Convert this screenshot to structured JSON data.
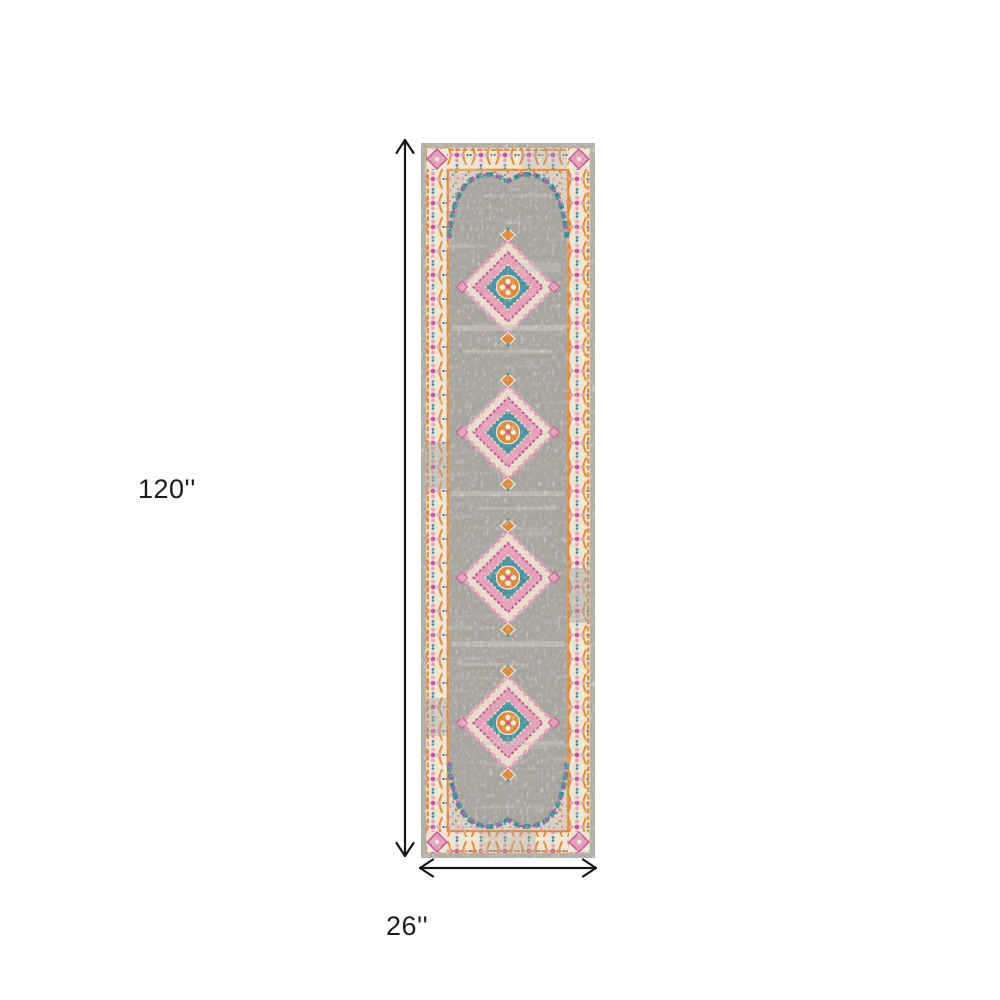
{
  "figure": {
    "background_color": "#ffffff",
    "arrow_color": "#161616",
    "text_color": "#1c1c1c",
    "height_label": "120''",
    "width_label": "26''"
  },
  "rug": {
    "description": "Grey, pink and orange distressed vintage Persian-style medallion runner rug",
    "medallion_count": 4,
    "palette": {
      "field": "#a8a49e",
      "field_light": "#cbc6be",
      "cream": "#f0e5d3",
      "cream_soft": "#e9dccb",
      "edge_gray": "#b3aea6",
      "orange": "#db8a3e",
      "deep_orange": "#cf6d36",
      "magenta": "#c4559a",
      "pink": "#e4a0b8",
      "teal": "#4d929e",
      "blue": "#3d6f93"
    }
  }
}
